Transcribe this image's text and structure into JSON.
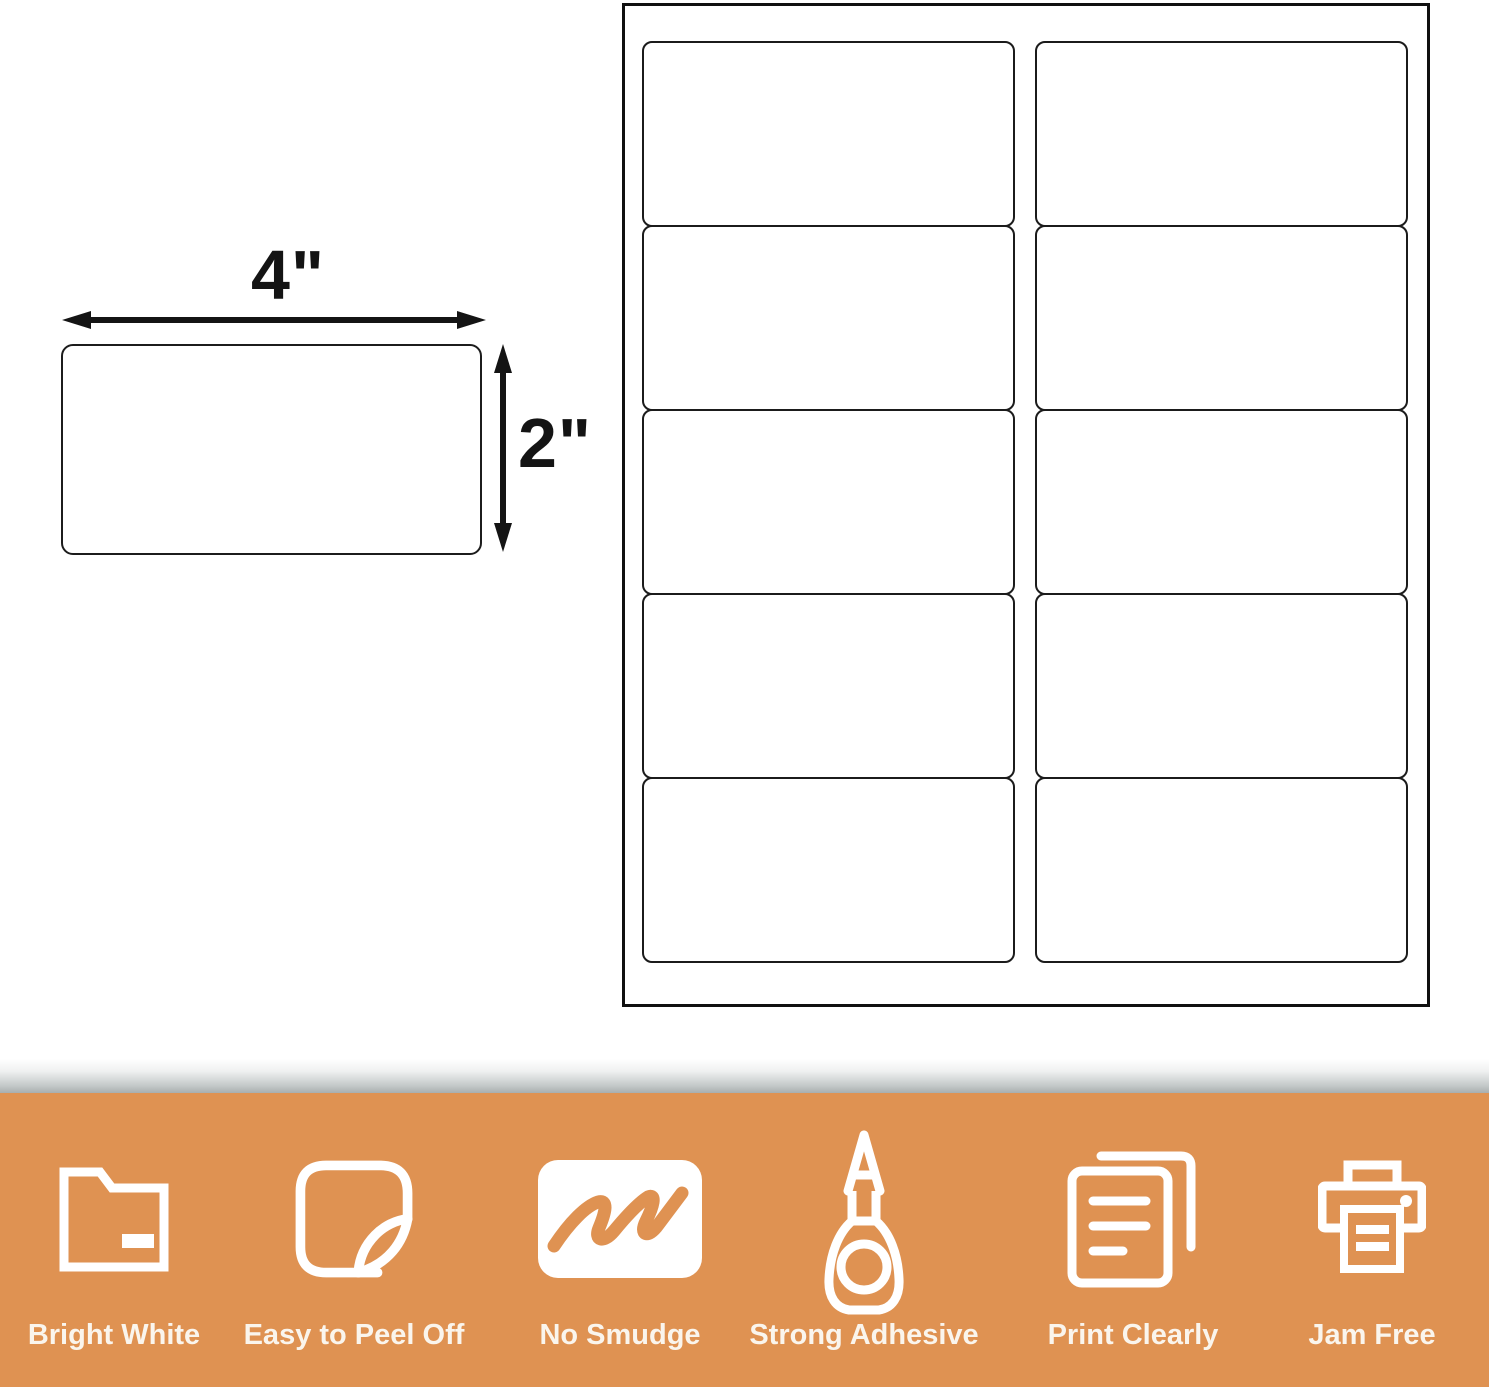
{
  "diagram": {
    "width_label": "4\"",
    "height_label": "2\""
  },
  "sheet": {
    "rows": 5,
    "columns": 2,
    "labels_total": 10
  },
  "banner": {
    "bg_color": "#DF9252",
    "text_color": "#FAF5ED",
    "features": [
      {
        "label": "Bright White",
        "icon": "folder-icon"
      },
      {
        "label": "Easy to Peel Off",
        "icon": "peel-sticker-icon"
      },
      {
        "label": "No Smudge",
        "icon": "marker-scribble-icon"
      },
      {
        "label": "Strong Adhesive",
        "icon": "glue-bottle-icon"
      },
      {
        "label": "Print Clearly",
        "icon": "documents-icon"
      },
      {
        "label": "Jam Free",
        "icon": "printer-icon"
      }
    ]
  }
}
